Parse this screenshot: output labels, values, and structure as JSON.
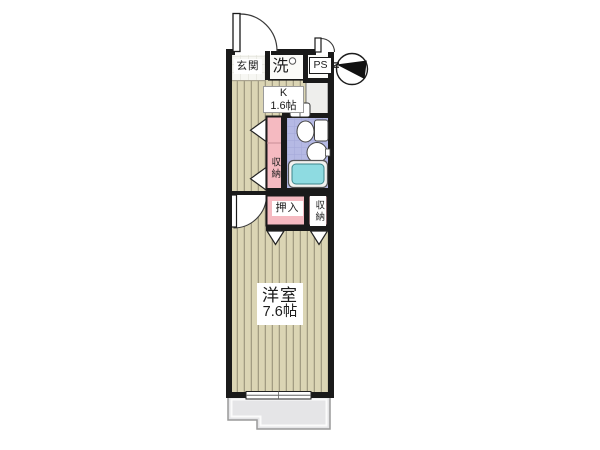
{
  "plan": {
    "type": "apartment-floor-plan",
    "rooms": {
      "entrance_label": "玄関",
      "laundry_label": "洗",
      "pipe_space_label": "PS",
      "kitchen_name": "K",
      "kitchen_size": "1.6帖",
      "hall_storage_label": "収納",
      "closet_label": "押入",
      "room_storage_label": "収納",
      "main_room_name": "洋室",
      "main_room_size": "7.6帖"
    },
    "compass": {
      "north_label": "N"
    },
    "colors": {
      "wall": "#1a1a1a",
      "flooring_base": "#dbd5b4",
      "flooring_stripe": "#a29c82",
      "genkan_tile": "#f7f7f3",
      "genkan_tile_line": "#ddddd5",
      "pink": "#f5bac1",
      "pink_divider": "#c98f98",
      "bath_tile": "#b5b9e4",
      "bath_tile_line": "#a3a7d9",
      "bathtub": "#8edbe1",
      "bathtub_edge": "#3d868c",
      "balcony": "#e5e5e7",
      "balcony_edge": "#9a9a9a",
      "fixture_line": "#444444",
      "counter": "#eeeeec"
    }
  }
}
